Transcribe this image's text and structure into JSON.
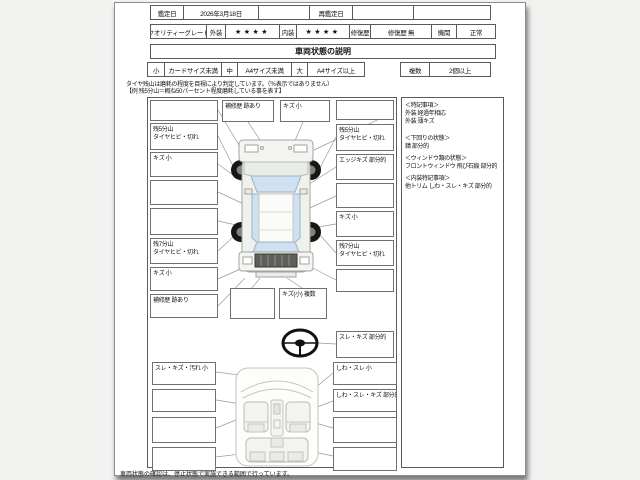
{
  "header": {
    "appraisal_date_label": "鑑定日",
    "appraisal_date_value": "2026年3月18日",
    "blank1": "",
    "reappraisal_date_label": "再鑑定日",
    "reappraisal_date_value": "",
    "blank2": "",
    "grade_label": "クオリティーグレード",
    "exterior_label": "外装",
    "exterior_stars": "★★★★",
    "interior_label": "内装",
    "interior_stars": "★★★★",
    "repair_label": "修復歴",
    "repair_value": "修復歴 無",
    "engine_label": "機関",
    "engine_value": "正常"
  },
  "title": "車両状態の説明",
  "size_legend": {
    "small_label": "小",
    "small_value": "カードサイズ未満",
    "medium_label": "中",
    "medium_value": "A4サイズ未満",
    "large_label": "大",
    "large_value": "A4サイズ以上",
    "multiple_label": "複数",
    "multiple_value": "2個以上"
  },
  "notes": {
    "line1": "タイヤ残山は磨耗の程度を目視により判定しています。（％表示ではありません）",
    "line2": "【例 残5分山＝概ね50パーセント程度磨耗している事を表す】"
  },
  "exterior": {
    "top": [
      "補修歴 跡あり",
      "キズ 小"
    ],
    "left": [
      {
        "l1": "",
        "l2": ""
      },
      {
        "l1": "残5分山",
        "l2": "タイヤヒビ・切れ"
      },
      {
        "l1": "キズ 小",
        "l2": ""
      },
      {
        "l1": "",
        "l2": ""
      },
      {
        "l1": "",
        "l2": ""
      },
      {
        "l1": "残7分山",
        "l2": "タイヤヒビ・切れ"
      },
      {
        "l1": "キズ 小",
        "l2": ""
      },
      {
        "l1": "補修歴 跡あり",
        "l2": ""
      }
    ],
    "right": [
      {
        "l1": "",
        "l2": ""
      },
      {
        "l1": "残5分山",
        "l2": "タイヤヒビ・切れ"
      },
      {
        "l1": "エッジキズ 部分的",
        "l2": ""
      },
      {
        "l1": "",
        "l2": ""
      },
      {
        "l1": "キズ 小",
        "l2": ""
      },
      {
        "l1": "残7分山",
        "l2": "タイヤヒビ・切れ"
      },
      {
        "l1": "",
        "l2": ""
      }
    ],
    "center": [
      "",
      "キズ(小) 複数"
    ],
    "steering_label": "スレ・キズ 部分的"
  },
  "interior": {
    "left": [
      "スレ・キズ・汚れ 小",
      "",
      "",
      ""
    ],
    "right": [
      "しわ・スレ 小",
      "しわ・スレ・キズ 部分的",
      "",
      ""
    ]
  },
  "remarks": {
    "section1_title": "＜特記事項＞",
    "section1_line1": "外装 経過年相応",
    "section1_line2": "外装 薄キズ",
    "section2_title": "＜下回りの状態＞",
    "section2_line1": "錆 部分的",
    "section3_title": "＜ウィンドウ類の状態＞",
    "section3_line1": "フロントウィンドウ 飛び石痕 部分的",
    "section4_title": "＜内装特記事項＞",
    "section4_line1": "他トリム しわ・スレ・キズ 部分的"
  },
  "footer": "車両状態の確認は、停止状態で実施できる範囲で行っています。",
  "colors": {
    "glass_blue": "#cfe1f0",
    "car_body": "#eff1ed",
    "tire_black": "#161616",
    "page_bg": "#ffffff",
    "surround_bg": "#f2f2f1"
  }
}
